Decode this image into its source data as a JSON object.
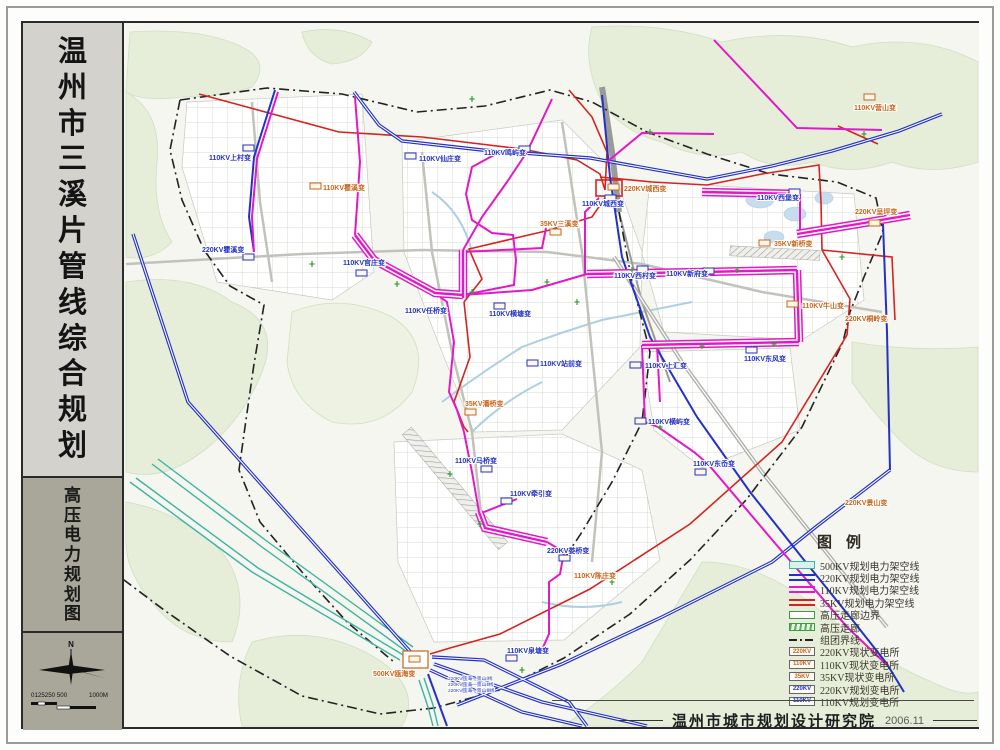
{
  "sidebar": {
    "title": "温州市三溪片管线综合规划",
    "subtitle": "高压电力规划图",
    "compass_label": "N",
    "scale_left": "0125250 500",
    "scale_right": "1000M"
  },
  "legend": {
    "title": "图例",
    "items": [
      {
        "swatch": "l500",
        "label": "500KV规划电力架空线"
      },
      {
        "swatch": "l220",
        "label": "220KV规划电力架空线"
      },
      {
        "swatch": "l110",
        "label": "110KV规划电力架空线"
      },
      {
        "swatch": "l35",
        "label": "35KV规划电力架空线"
      },
      {
        "swatch": "edge",
        "label": "高压走廊边界"
      },
      {
        "swatch": "corr",
        "label": "高压走廊"
      },
      {
        "swatch": "dash",
        "label": "组团界线"
      },
      {
        "swatch": "box",
        "box": "220KV",
        "kind": "existing",
        "label": "220KV现状变电所"
      },
      {
        "swatch": "box",
        "box": "110KV",
        "kind": "existing",
        "label": "110KV现状变电所"
      },
      {
        "swatch": "box",
        "box": "35KV",
        "kind": "existing",
        "label": "35KV现状变电所"
      },
      {
        "swatch": "box",
        "box": "220KV",
        "kind": "planned",
        "label": "220KV规划变电所"
      },
      {
        "swatch": "box",
        "box": "110KV",
        "kind": "planned",
        "label": "110KV规划变电所"
      }
    ]
  },
  "footer": {
    "credit": "温州市城市规划设计研究院",
    "date": "2006.11"
  },
  "colors": {
    "planned_label": "#2433c0",
    "existing_label": "#c8651a",
    "kv500": "#3db3a3",
    "kv220": "#2431c8",
    "kv110": "#e318c8",
    "kv35": "#d42420",
    "corridor_green": "#3a9d3a"
  },
  "map": {
    "substations": [
      {
        "label": "110KV上村变",
        "x": 207,
        "y": 158,
        "kind": "planned",
        "m": [
          241,
          143
        ]
      },
      {
        "label": "110KV瞿溪变",
        "x": 321,
        "y": 188,
        "kind": "existing",
        "m": [
          308,
          181
        ]
      },
      {
        "label": "220KV瞿溪变",
        "x": 200,
        "y": 250,
        "kind": "planned",
        "m": [
          241,
          252
        ]
      },
      {
        "label": "110KV官庄变",
        "x": 341,
        "y": 263,
        "kind": "planned",
        "m": [
          354,
          268
        ]
      },
      {
        "label": "110KV仙庄变",
        "x": 417,
        "y": 159,
        "kind": "planned",
        "m": [
          403,
          151
        ]
      },
      {
        "label": "110KV鸣屿变",
        "x": 482,
        "y": 153,
        "kind": "planned",
        "m": [
          517,
          144
        ]
      },
      {
        "label": "220KV城西变",
        "x": 622,
        "y": 189,
        "kind": "existing",
        "m": [
          606,
          182
        ]
      },
      {
        "label": "110KV城西变",
        "x": 580,
        "y": 204,
        "kind": "planned",
        "m": [
          603,
          193
        ]
      },
      {
        "label": "35KV三溪变",
        "x": 538,
        "y": 224,
        "kind": "existing",
        "m": [
          548,
          227
        ]
      },
      {
        "label": "110KV西村变",
        "x": 612,
        "y": 276,
        "kind": "planned",
        "m": [
          635,
          264
        ]
      },
      {
        "label": "110KV新府变",
        "x": 664,
        "y": 274,
        "kind": "planned",
        "m": [
          701,
          266
        ]
      },
      {
        "label": "110KV营山变",
        "x": 852,
        "y": 108,
        "kind": "existing",
        "m": [
          862,
          92
        ]
      },
      {
        "label": "110KV西堡变",
        "x": 755,
        "y": 198,
        "kind": "planned",
        "m": [
          787,
          187
        ]
      },
      {
        "label": "220KV呈坪变",
        "x": 853,
        "y": 212,
        "kind": "existing",
        "m": [
          867,
          218
        ]
      },
      {
        "label": "35KV新桥变",
        "x": 772,
        "y": 244,
        "kind": "existing",
        "m": [
          757,
          238
        ]
      },
      {
        "label": "110KV牛山变",
        "x": 800,
        "y": 306,
        "kind": "existing",
        "m": [
          785,
          299
        ]
      },
      {
        "label": "220KV桐岭变",
        "x": 843,
        "y": 319,
        "kind": "existing"
      },
      {
        "label": "110KV任桥变",
        "x": 403,
        "y": 311,
        "kind": "planned"
      },
      {
        "label": "110KV横塘变",
        "x": 487,
        "y": 314,
        "kind": "planned",
        "m": [
          492,
          301
        ]
      },
      {
        "label": "110KV站前变",
        "x": 538,
        "y": 364,
        "kind": "planned",
        "m": [
          525,
          358
        ]
      },
      {
        "label": "110KV上汇变",
        "x": 643,
        "y": 366,
        "kind": "planned",
        "m": [
          628,
          360
        ]
      },
      {
        "label": "110KV东风变",
        "x": 742,
        "y": 359,
        "kind": "planned",
        "m": [
          744,
          345
        ]
      },
      {
        "label": "35KV潘桥变",
        "x": 463,
        "y": 404,
        "kind": "existing",
        "m": [
          463,
          407
        ]
      },
      {
        "label": "110KV横屿变",
        "x": 646,
        "y": 422,
        "kind": "planned",
        "m": [
          633,
          416
        ]
      },
      {
        "label": "110KV马桥变",
        "x": 453,
        "y": 461,
        "kind": "planned",
        "m": [
          479,
          464
        ]
      },
      {
        "label": "110KV东岙变",
        "x": 691,
        "y": 464,
        "kind": "planned",
        "m": [
          693,
          467
        ]
      },
      {
        "label": "110KV牵引变",
        "x": 508,
        "y": 494,
        "kind": "planned",
        "m": [
          499,
          496
        ]
      },
      {
        "label": "220KV娄桥变",
        "x": 545,
        "y": 551,
        "kind": "planned",
        "m": [
          557,
          553
        ]
      },
      {
        "label": "110KV陈庄变",
        "x": 572,
        "y": 576,
        "kind": "existing"
      },
      {
        "label": "110KV泉塘变",
        "x": 505,
        "y": 651,
        "kind": "planned",
        "m": [
          504,
          653
        ]
      },
      {
        "label": "500KV瓯海变",
        "x": 371,
        "y": 674,
        "kind": "existing",
        "big": [
          401,
          649,
          25,
          17
        ],
        "m": [
          407,
          654
        ]
      },
      {
        "label": "220KV景山变",
        "x": 843,
        "y": 503,
        "kind": "existing"
      }
    ],
    "line_labels": [
      {
        "text": "220KV瓯海—景山Ⅰ线",
        "x": 446,
        "y": 678
      },
      {
        "text": "220KV瓯海—景山Ⅱ线",
        "x": 446,
        "y": 684
      },
      {
        "text": "220KV瓯海—景山Ⅲ线",
        "x": 446,
        "y": 690
      }
    ]
  }
}
